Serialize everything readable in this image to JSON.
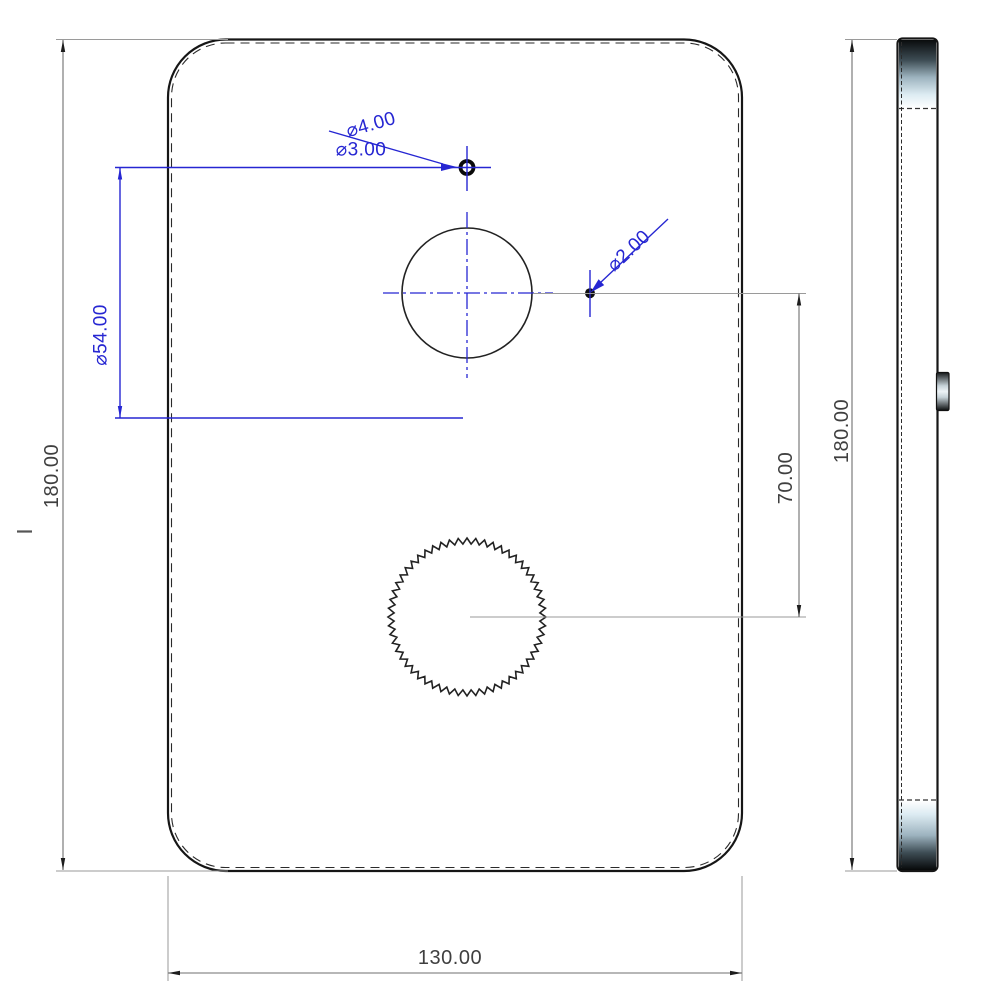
{
  "dims": {
    "front_height": "180.00",
    "front_width": "130.00",
    "feature_diameter": "⌀54.00",
    "top_hole_outer": "⌀4.00",
    "top_hole_inner": "⌀3.00",
    "pin_hole": "⌀2.00",
    "hole_spacing": "70.00",
    "side_height": "180.00"
  },
  "colors": {
    "annotation_blue": "#2626d2",
    "extension_line_gray": "#9a9a9a",
    "dimension_line_gray": "#6f6f6f",
    "edge_black": "#161616",
    "dimension_text": "#3f3f3f"
  }
}
